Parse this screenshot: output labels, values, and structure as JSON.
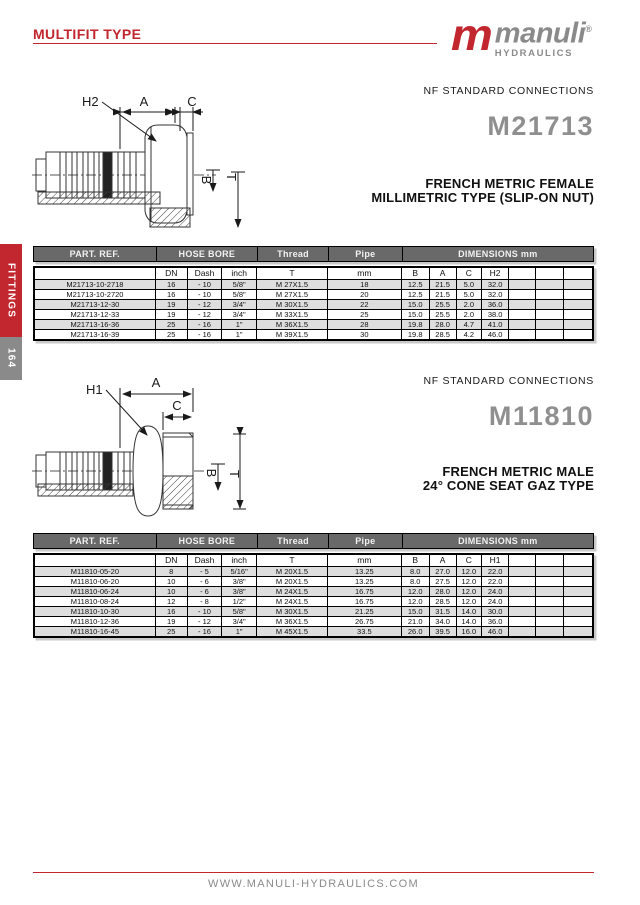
{
  "header": {
    "title": "MULTIFIT TYPE"
  },
  "brand": {
    "mark": "m",
    "name": "manuli",
    "reg": "®",
    "sub": "HYDRAULICS"
  },
  "sidebar": {
    "category": "FITTINGS",
    "page_number": "164"
  },
  "footer": {
    "website": "WWW.MANULI-HYDRAULICS.COM"
  },
  "colors": {
    "accent_red": "#c2262e",
    "logo_gray": "#8a8a8a",
    "table_header_bg": "#696969",
    "row_stripe": "#dedede"
  },
  "sections": [
    {
      "standard": "NF STANDARD CONNECTIONS",
      "model": "M21713",
      "title_line1": "FRENCH METRIC FEMALE",
      "title_line2": "MILLIMETRIC TYPE (SLIP-ON NUT)",
      "drawing": {
        "h_label": "H2",
        "a_label": "A",
        "c_label": "C",
        "b_label": "B",
        "t_label": "T"
      },
      "table": {
        "group_headers": [
          "PART. REF.",
          "HOSE BORE",
          "Thread",
          "Pipe",
          "DIMENSIONS mm"
        ],
        "sub_headers": [
          "",
          "DN",
          "Dash",
          "inch",
          "T",
          "mm",
          "B",
          "A",
          "C",
          "H2",
          "",
          "",
          ""
        ],
        "rows": [
          [
            "M21713-10-2718",
            "16",
            "- 10",
            "5/8\"",
            "M 27X1.5",
            "18",
            "12.5",
            "21.5",
            "5.0",
            "32.0",
            "",
            "",
            ""
          ],
          [
            "M21713-10-2720",
            "16",
            "- 10",
            "5/8\"",
            "M 27X1.5",
            "20",
            "12.5",
            "21.5",
            "5.0",
            "32.0",
            "",
            "",
            ""
          ],
          [
            "M21713-12-30",
            "19",
            "- 12",
            "3/4\"",
            "M 30X1.5",
            "22",
            "15.0",
            "25.5",
            "2.0",
            "36.0",
            "",
            "",
            ""
          ],
          [
            "M21713-12-33",
            "19",
            "- 12",
            "3/4\"",
            "M 33X1.5",
            "25",
            "15.0",
            "25.5",
            "2.0",
            "38.0",
            "",
            "",
            ""
          ],
          [
            "M21713-16-36",
            "25",
            "- 16",
            "1\"",
            "M 36X1.5",
            "28",
            "19.8",
            "28.0",
            "4.7",
            "41.0",
            "",
            "",
            ""
          ],
          [
            "M21713-16-39",
            "25",
            "- 16",
            "1\"",
            "M 39X1.5",
            "30",
            "19.8",
            "28.5",
            "4.2",
            "46.0",
            "",
            "",
            ""
          ]
        ]
      }
    },
    {
      "standard": "NF STANDARD CONNECTIONS",
      "model": "M11810",
      "title_line1": "FRENCH METRIC MALE",
      "title_line2": "24° CONE SEAT GAZ TYPE",
      "drawing": {
        "h_label": "H1",
        "a_label": "A",
        "c_label": "C",
        "b_label": "B",
        "t_label": "T"
      },
      "table": {
        "group_headers": [
          "PART. REF.",
          "HOSE BORE",
          "Thread",
          "Pipe",
          "DIMENSIONS mm"
        ],
        "sub_headers": [
          "",
          "DN",
          "Dash",
          "inch",
          "T",
          "mm",
          "B",
          "A",
          "C",
          "H1",
          "",
          "",
          ""
        ],
        "rows": [
          [
            "M11810-05-20",
            "8",
            "- 5",
            "5/16\"",
            "M 20X1.5",
            "13.25",
            "8.0",
            "27.0",
            "12.0",
            "22.0",
            "",
            "",
            ""
          ],
          [
            "M11810-06-20",
            "10",
            "- 6",
            "3/8\"",
            "M 20X1.5",
            "13.25",
            "8.0",
            "27.5",
            "12.0",
            "22.0",
            "",
            "",
            ""
          ],
          [
            "M11810-06-24",
            "10",
            "- 6",
            "3/8\"",
            "M 24X1.5",
            "16.75",
            "12.0",
            "28.0",
            "12.0",
            "24.0",
            "",
            "",
            ""
          ],
          [
            "M11810-08-24",
            "12",
            "- 8",
            "1/2\"",
            "M 24X1.5",
            "16.75",
            "12.0",
            "28.5",
            "12.0",
            "24.0",
            "",
            "",
            ""
          ],
          [
            "M11810-10-30",
            "16",
            "- 10",
            "5/8\"",
            "M 30X1.5",
            "21.25",
            "15.0",
            "31.5",
            "14.0",
            "30.0",
            "",
            "",
            ""
          ],
          [
            "M11810-12-36",
            "19",
            "- 12",
            "3/4\"",
            "M 36X1.5",
            "26.75",
            "21.0",
            "34.0",
            "14.0",
            "36.0",
            "",
            "",
            ""
          ],
          [
            "M11810-16-45",
            "25",
            "- 16",
            "1\"",
            "M 45X1.5",
            "33.5",
            "26.0",
            "39.5",
            "16.0",
            "46.0",
            "",
            "",
            ""
          ]
        ]
      }
    }
  ]
}
